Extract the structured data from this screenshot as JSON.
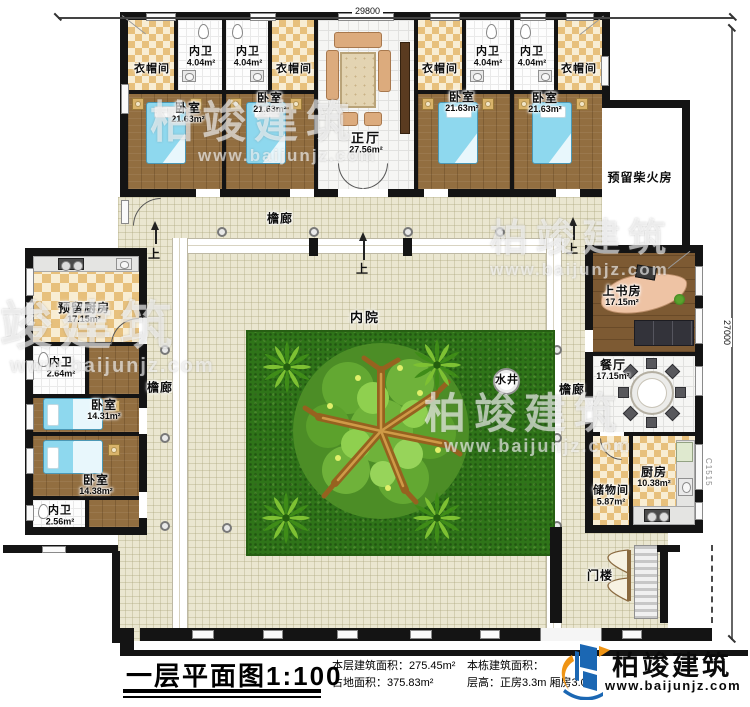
{
  "dimensions": {
    "top": "29800",
    "right": "27000",
    "window_code": "C1515"
  },
  "nav": {
    "up": "上"
  },
  "rooms": {
    "cloak_a": {
      "label": "衣帽间"
    },
    "bath_a": {
      "label": "内卫",
      "area": "4.04m²"
    },
    "bed_a": {
      "label": "卧室",
      "area": "21.63m²"
    },
    "bath_b": {
      "label": "内卫",
      "area": "4.04m²"
    },
    "cloak_b": {
      "label": "衣帽间"
    },
    "bed_b": {
      "label": "卧室",
      "area": "21.63m²"
    },
    "hall": {
      "label": "正厅",
      "area": "27.56m²"
    },
    "cloak_c": {
      "label": "衣帽间"
    },
    "bath_c": {
      "label": "内卫",
      "area": "4.04m²"
    },
    "bed_c": {
      "label": "卧室",
      "area": "21.63m²"
    },
    "bath_d": {
      "label": "内卫",
      "area": "4.04m²"
    },
    "cloak_d": {
      "label": "衣帽间"
    },
    "bed_d": {
      "label": "卧室",
      "area": "21.63m²"
    },
    "firewood": {
      "label": "预留柴火房"
    },
    "kitchen_reserved": {
      "label": "预留厨房",
      "area": "17.15m²"
    },
    "bath_w1": {
      "label": "内卫",
      "area": "2.64m²"
    },
    "bed_w1": {
      "label": "卧室",
      "area": "14.31m²"
    },
    "bed_w2": {
      "label": "卧室",
      "area": "14.38m²"
    },
    "bath_w2": {
      "label": "内卫",
      "area": "2.56m²"
    },
    "study": {
      "label": "上书房",
      "area": "17.15m²"
    },
    "dining": {
      "label": "餐厅",
      "area": "17.15m²"
    },
    "storage": {
      "label": "储物间",
      "area": "5.87m²"
    },
    "kitchen": {
      "label": "厨房",
      "area": "10.38m²"
    },
    "corridor": {
      "label": "檐廊"
    },
    "courtyard": {
      "label": "内院"
    },
    "well": {
      "label": "水井"
    },
    "gatehouse": {
      "label": "门楼"
    }
  },
  "titleblock": {
    "title": "一层平面图1:100",
    "stats_left": [
      "本层建筑面积：275.45m²",
      "占地面积：375.83m²"
    ],
    "stats_right": [
      "本栋建筑面积：",
      "层高：正房3.3m  厢房3.0m"
    ]
  },
  "logo": {
    "name": "柏竣建筑",
    "url": "www.baijunjz.com"
  },
  "watermark": {
    "name": "柏竣建筑",
    "url": "www.baijunjz.com"
  }
}
